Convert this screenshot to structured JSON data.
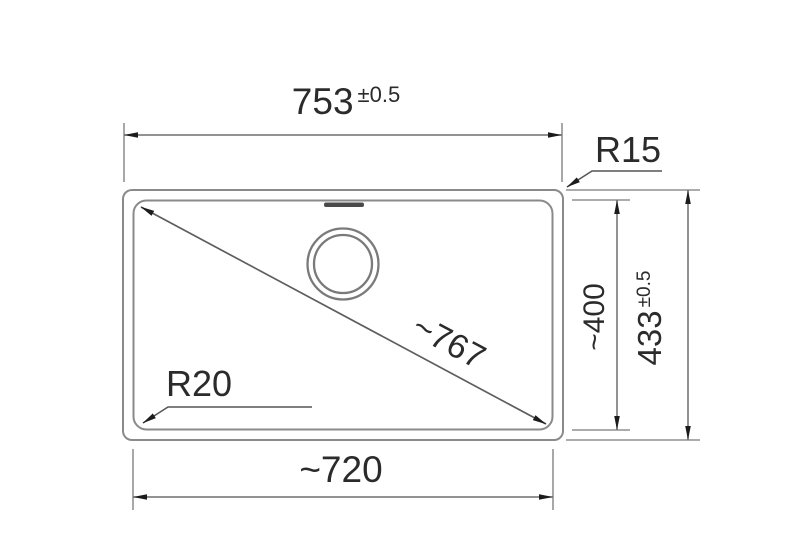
{
  "drawing": {
    "type": "technical-dimension-drawing",
    "subject": "rectangular sink bowl, top view with dimensions",
    "colors": {
      "background": "#ffffff",
      "outline": "#8a8a8a",
      "dimension_line": "#6e6e6e",
      "arrow": "#1c1c1c",
      "text": "#2b2b2b",
      "overflow_slot": "#4a4a4a"
    },
    "dimensions": {
      "top_width": {
        "value": "753",
        "tolerance": "±0.5",
        "meaning": "overall outer width"
      },
      "outer_corner_radius": {
        "label": "R15"
      },
      "inner_depth": {
        "value": "~400",
        "meaning": "inner front-to-back depth"
      },
      "outer_depth": {
        "value": "433",
        "tolerance": "±0.5",
        "meaning": "overall outer depth"
      },
      "diagonal": {
        "value": "~767",
        "meaning": "inner diagonal"
      },
      "inner_corner_radius": {
        "label": "R20"
      },
      "bottom_inner_width": {
        "value": "~720",
        "meaning": "inner width"
      }
    }
  }
}
